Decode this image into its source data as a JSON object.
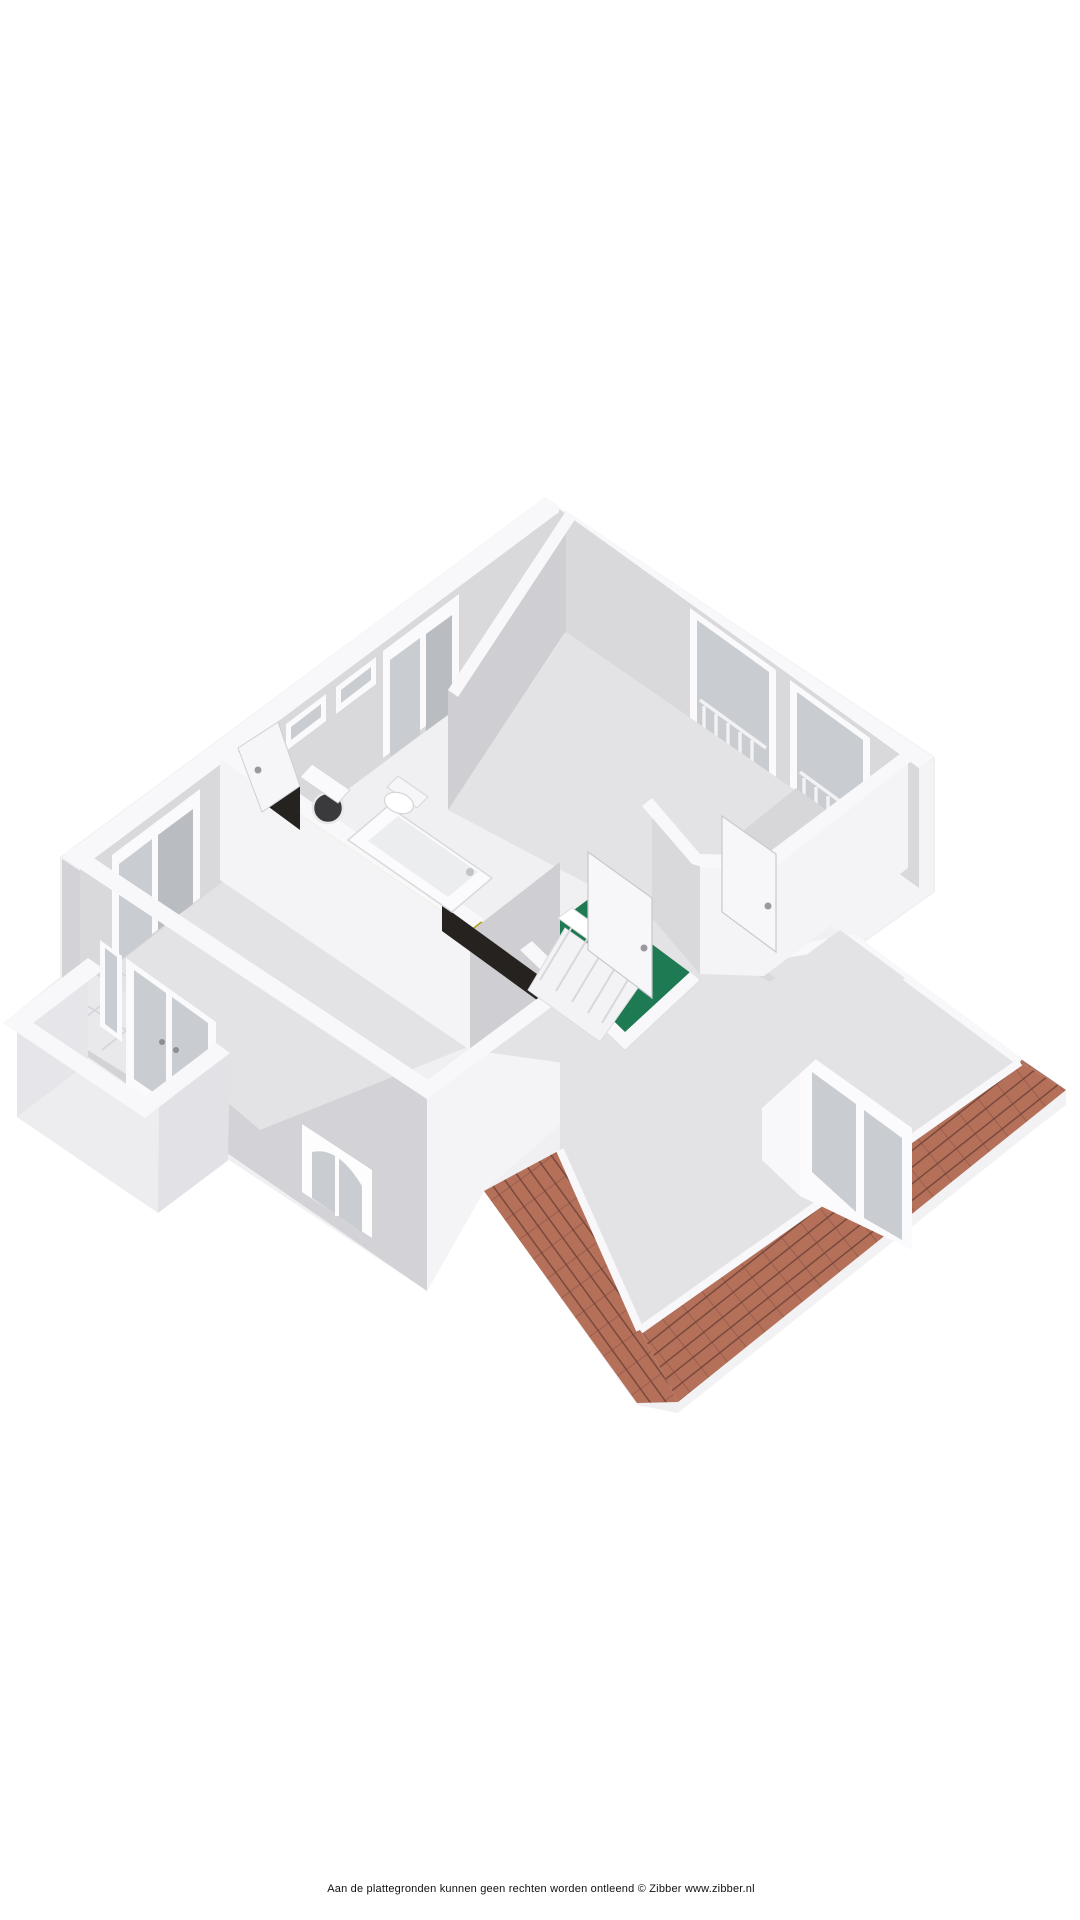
{
  "document": {
    "kind": "3d-floorplan-render",
    "projection": "isometric-cutaway",
    "background": "#ffffff"
  },
  "footer": {
    "disclaimer": "Aan de plattegronden kunnen geen rechten worden ontleend © Zibber www.zibber.nl"
  },
  "colors": {
    "background": "#ffffff",
    "base": "#f0f0f2",
    "wall_top": "#f8f8fa",
    "wall_face_light": "#f4f4f6",
    "wall_face_mid": "#d9d9dc",
    "wall_face_dark": "#cfcfd3",
    "exterior_face": "#d3d3d7",
    "floor": "#e3e3e6",
    "floor_dark": "#d7d7da",
    "bathroom_floor": "#b5a41e",
    "landing_floor": "#1e7a52",
    "roof_tile": "#b5705a",
    "roof_tile_line": "#6e4236",
    "roof_fascia": "#f2f2f4",
    "glass": "#c9ccd0",
    "glass_dark": "#b9bcc0",
    "shadow_gap": "#262220",
    "text": "#111111"
  },
  "rooms": [
    {
      "id": "bedroom-main",
      "floor_color_key": "floor"
    },
    {
      "id": "bedroom-left",
      "floor_color_key": "floor"
    },
    {
      "id": "bathroom",
      "floor_color_key": "bathroom_floor"
    },
    {
      "id": "stair-landing",
      "floor_color_key": "landing_floor"
    },
    {
      "id": "hallway",
      "floor_color_key": "floor"
    },
    {
      "id": "storage",
      "floor_color_key": "floor"
    },
    {
      "id": "attic-room",
      "floor_color_key": "floor"
    },
    {
      "id": "balcony",
      "floor_color_key": "floor_dark"
    }
  ]
}
